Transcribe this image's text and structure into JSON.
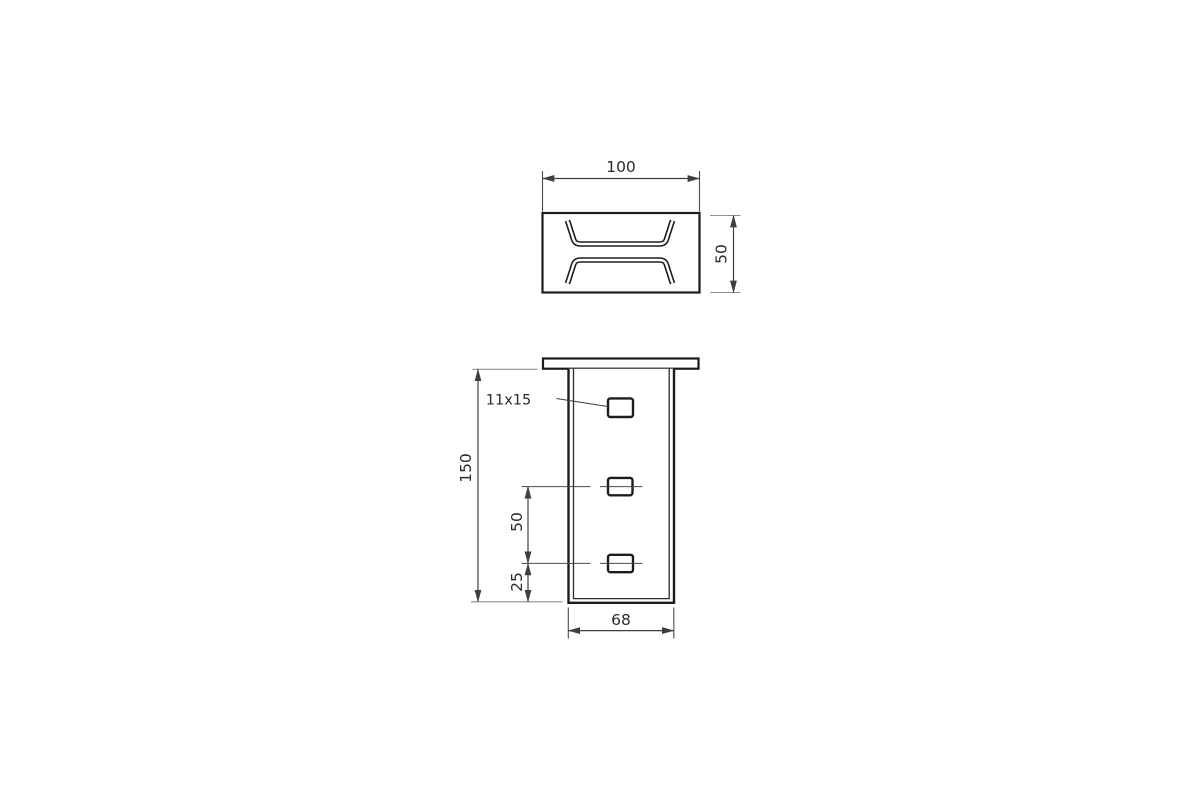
{
  "page": {
    "background": "#ffffff",
    "kind": "technical-drawing"
  },
  "drawing": {
    "line_color": "#1c1c1c",
    "dimension_color": "#3f3f3f",
    "views": [
      {
        "id": "top-view",
        "description": "channel profile cross-section (top view)"
      },
      {
        "id": "front-view",
        "description": "upright with top flange and three slots (front view)"
      }
    ],
    "labels": {
      "top_width": "100",
      "top_depth": "50",
      "total_height": "150",
      "slot_spacing": "50",
      "slot_bottom_offset": "25",
      "body_width": "68",
      "slot_size": "11x15"
    }
  }
}
